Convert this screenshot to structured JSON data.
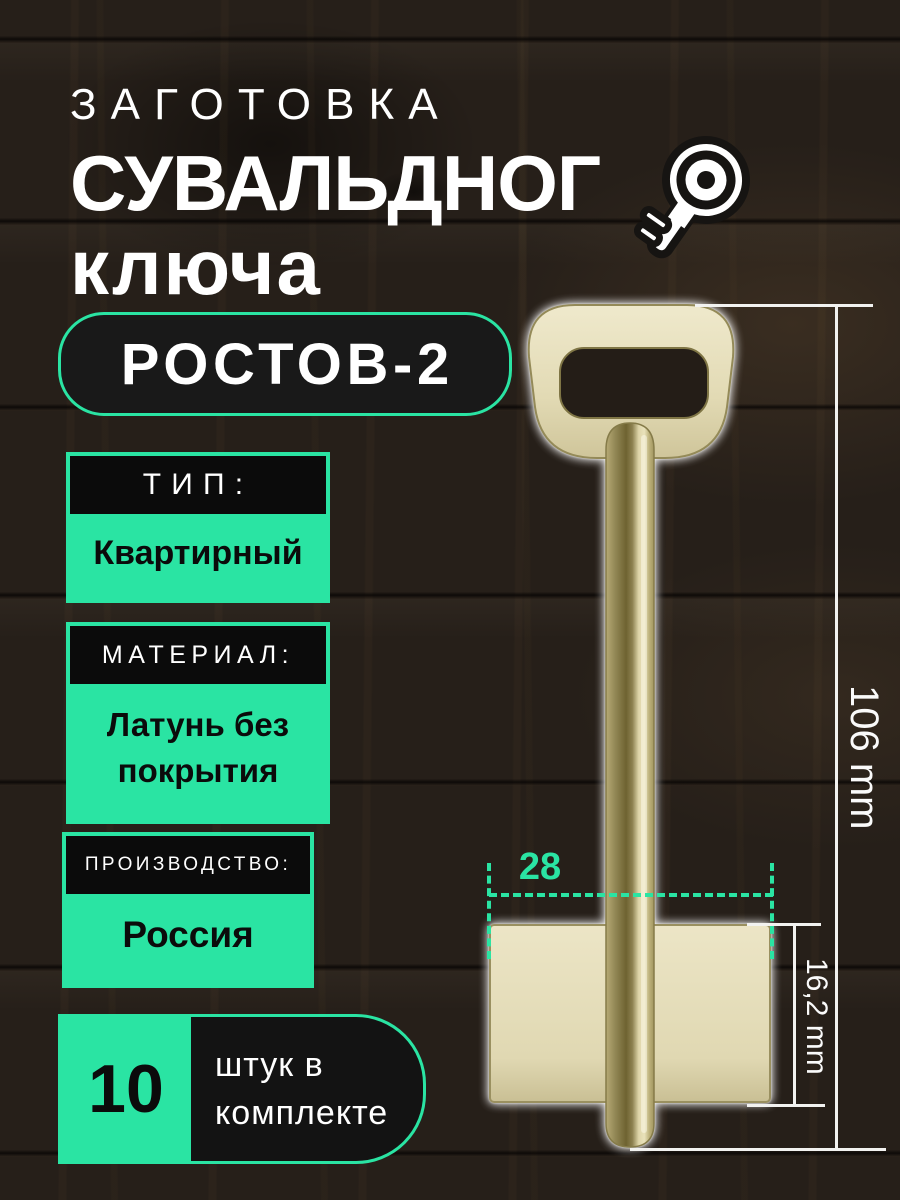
{
  "title": {
    "line1": "ЗАГОТОВКА",
    "line2": "СУВАЛЬДНОГ",
    "line2_icon": "key-icon",
    "line3": "ключа"
  },
  "model_badge": {
    "label": "РОСТОВ-2"
  },
  "specs": [
    {
      "header": "ТИП:",
      "value": "Квартирный"
    },
    {
      "header": "МАТЕРИАЛ:",
      "value": "Латунь без покрытия"
    },
    {
      "header": "ПРОИЗВОДСТВО:",
      "value": "Россия"
    }
  ],
  "quantity_badge": {
    "number": "10",
    "line1": "штук в",
    "line2": "комплекте"
  },
  "dimensions": {
    "blade_width": "28",
    "bit_height": "16,2 mm",
    "total_length": "106 mm"
  },
  "colors": {
    "accent_green": "#2ae4a3",
    "header_black": "#0b0b0b",
    "brass_light": "#e9e2c2",
    "brass_dark": "#6e6331",
    "background_wood": "#261f19",
    "text_white": "#ffffff"
  }
}
